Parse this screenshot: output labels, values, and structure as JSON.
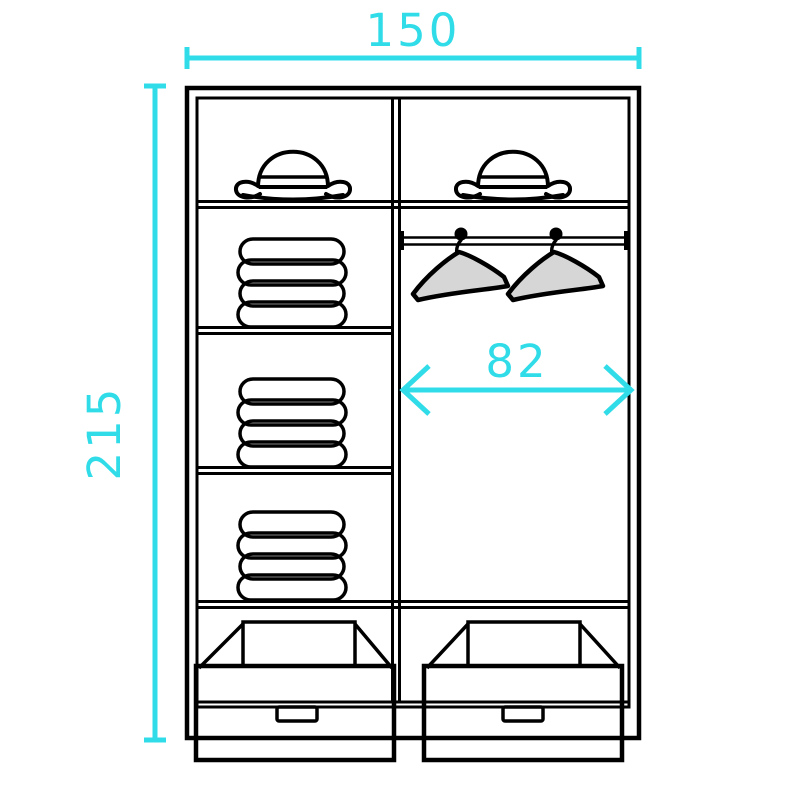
{
  "page": {
    "background": "#ffffff"
  },
  "diagram": {
    "name": "Wardrobe interior dimensions diagram",
    "dimensions": {
      "overall_width": "150",
      "overall_height": "215",
      "hanging_section_width": "82"
    },
    "contents": {
      "hat_compartments": 2,
      "hats": 2,
      "towel_stacks": 3,
      "towels_per_stack": 4,
      "hangers": 2,
      "hanging_rods": 1,
      "drawers": 2
    },
    "colors": {
      "dimension_accent": "#2fdce8",
      "outline": "#000000",
      "item_fill": "#d6d6d6",
      "drawer_fill": "#e4e4e4",
      "rod_fill": "#6f6f6f",
      "background": "#ffffff"
    }
  }
}
